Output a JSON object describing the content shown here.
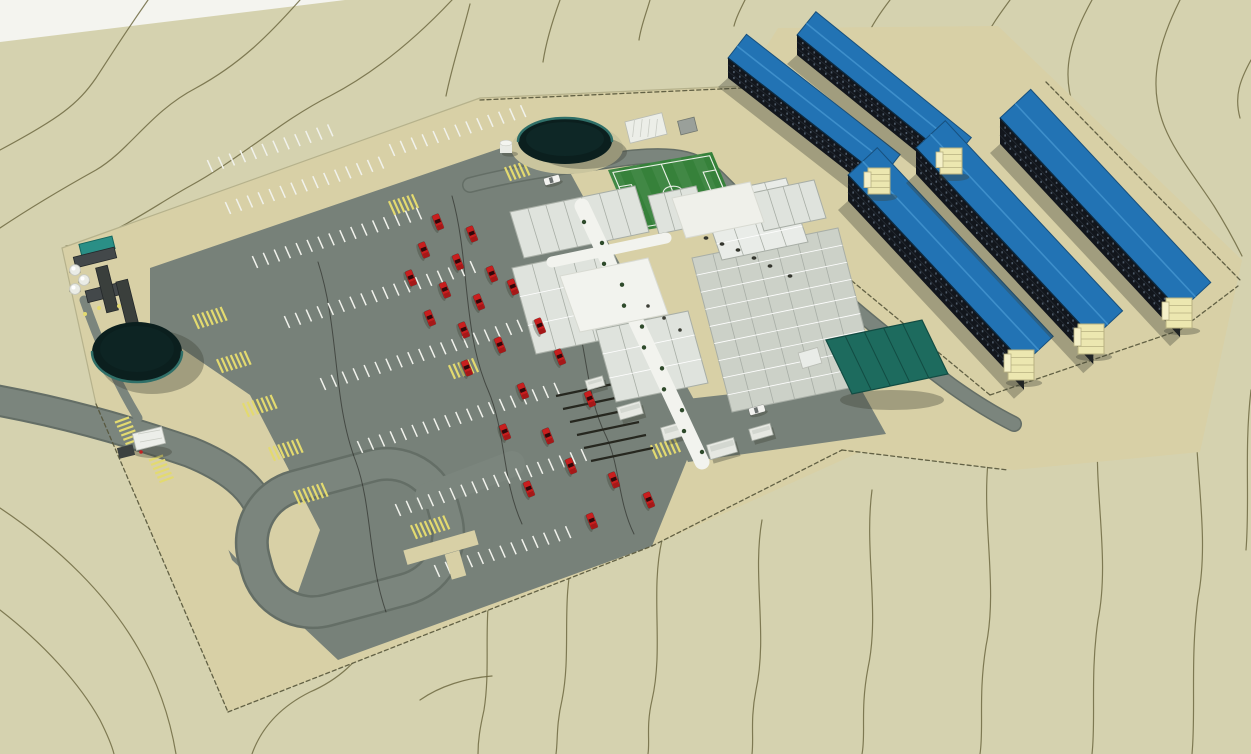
{
  "meta": {
    "type": "3d-architectural-rendering",
    "subject": "Aerial rendering of a desert workforce accommodation camp (man-camp) site plan",
    "view": "aerial-perspective",
    "image_width": 1251,
    "image_height": 754
  },
  "palette": {
    "terrain": "#d5d2af",
    "white_edge": "#f4f4ef",
    "contour_line": "#6f6a42",
    "utility_line": "#1c1c18",
    "site_pad": "#d8d0a6",
    "road": "#7b857d",
    "road_edge": "#646e66",
    "parking": "#778179",
    "stall_stripe": "#f1f2ec",
    "marking_yellow": "#e3da70",
    "roof_blue": "#2273b4",
    "roof_blue_ridge": "#3e8fcb",
    "roof_blue_edge": "#17507e",
    "facade_dark": "#12161c",
    "facade_floor_line": "#242a32",
    "window_dot": "#4e5a68",
    "stair_tower": "#ece7b0",
    "stair_tower_line": "#b7b181",
    "container_roof": "#dfe3dd",
    "container_seam": "#a8aea6",
    "hall_roof": "#ccd1c8",
    "hall_seam": "#eef0ea",
    "canopy_white": "#f2f3ee",
    "warehouse_teal": "#1d6b5e",
    "warehouse_teal_dark": "#124c43",
    "field_green": "#36813a",
    "field_line": "#eaf0e7",
    "tank_dark": "#0b1f1e",
    "tank_rim": "#2f6f68",
    "utility_canopy_teal": "#2a8f86",
    "car_red": "#c81e1e",
    "car_red_dark": "#a51818",
    "car_white": "#f2f2ef",
    "shadow": "rgba(60,62,52,0.35)",
    "fence": "#55543a",
    "pad_edge": "#b6b28c",
    "tree_green": "#2e4a2b"
  },
  "scene": {
    "terrain": {
      "description": "Sand-colored desert terrain with topographic contour lines",
      "contour_count": 27,
      "buried_utility_lines": 3
    },
    "site": {
      "description": "Fenced rectangular graded camp pad with internal roads and perimeter fence",
      "perimeter_fence": true
    },
    "areas": [
      {
        "name": "accommodation-blocks",
        "label": "Five long 3-story dormitory blocks with blue roofs, dark window facades and cream external stair towers",
        "count": 5,
        "north_row": 2,
        "south_row": 3,
        "stair_towers": 5
      },
      {
        "name": "central-camp",
        "label": "Modular container buildings with covered white walkways and canopies"
      },
      {
        "name": "dining-hall",
        "label": "Large panel-roof dining / services hall"
      },
      {
        "name": "recreation",
        "label": "Green soccer field with white markings"
      },
      {
        "name": "water-tanks",
        "label": "Two dark circular water reservoirs",
        "count": 2
      },
      {
        "name": "warehouse",
        "label": "Teal ribbed-roof warehouse with white annex"
      },
      {
        "name": "utility-plant",
        "label": "Utility yard with teal canopy, dark equipment skids and white cylindrical tanks"
      },
      {
        "name": "parking",
        "label": "Large striped parking lot with yellow hatched islands and crosswalks"
      },
      {
        "name": "gatehouse",
        "label": "Entry gatehouse with yellow crosswalks on approach road"
      },
      {
        "name": "loop-road",
        "label": "Turnaround loop road at the site entrance"
      }
    ],
    "vehicles": {
      "red_pickups": 24,
      "white_vans": 2
    }
  }
}
